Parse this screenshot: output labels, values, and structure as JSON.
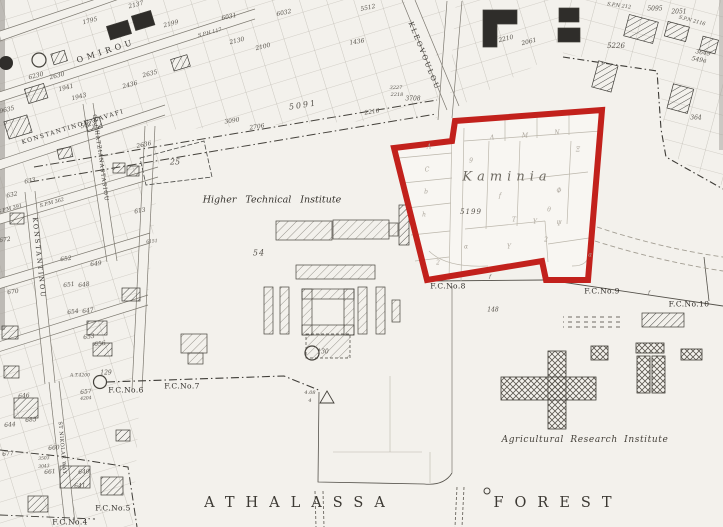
{
  "map": {
    "region_name": "Kaminia",
    "forest_word_left": "ATHALASSA",
    "forest_word_right": "FOREST",
    "institutes": {
      "higher_technical": "Higher Technical Institute",
      "agricultural": "Agricultural Research Institute"
    },
    "colors": {
      "boundary_red": "#c2211c",
      "paper": "#f3f1ec",
      "ink": "#3c3933"
    }
  },
  "fc_markers": [
    {
      "t": "F.C.No.4",
      "x": 70,
      "y": 522
    },
    {
      "t": "F.C.No.5",
      "x": 113,
      "y": 508
    },
    {
      "t": "F.C.No.6",
      "x": 126,
      "y": 390
    },
    {
      "t": "F.C.No.7",
      "x": 182,
      "y": 386
    },
    {
      "t": "F.C.No.8",
      "x": 448,
      "y": 286
    },
    {
      "t": "F.C.No.9",
      "x": 602,
      "y": 291
    },
    {
      "t": "F.C.No.10",
      "x": 689,
      "y": 304
    }
  ],
  "streets": [
    {
      "t": "OMIROU",
      "x": 106,
      "y": 51,
      "r": -18,
      "s": 8,
      "ls": 4
    },
    {
      "t": "KONSTANTINOU KAVAFI",
      "x": 73,
      "y": 127,
      "r": -17,
      "s": 6,
      "ls": 1.5
    },
    {
      "t": "G. CHATZIANASTASIOU",
      "x": 100,
      "y": 158,
      "r": 82,
      "s": 5.5,
      "ls": 1
    },
    {
      "t": "KONSTANTINOU",
      "x": 39,
      "y": 258,
      "r": 84,
      "s": 6.5,
      "ls": 2
    },
    {
      "t": "KLEOVOULOU",
      "x": 424,
      "y": 56,
      "r": 68,
      "s": 7,
      "ls": 2
    },
    {
      "t": "ST NIKOLAE WAY",
      "x": 62,
      "y": 448,
      "r": 85,
      "s": 5,
      "ls": 0.5
    }
  ],
  "plot_numbers": [
    {
      "t": "2137",
      "x": 136,
      "y": 5,
      "r": -15
    },
    {
      "t": "1795",
      "x": 90,
      "y": 21,
      "r": -15
    },
    {
      "t": "2199",
      "x": 171,
      "y": 24,
      "r": -15
    },
    {
      "t": "6031",
      "x": 229,
      "y": 17,
      "r": -12
    },
    {
      "t": "6032",
      "x": 284,
      "y": 13,
      "r": -12
    },
    {
      "t": "5512",
      "x": 368,
      "y": 8,
      "r": -12
    },
    {
      "t": "2130",
      "x": 237,
      "y": 41,
      "r": -14
    },
    {
      "t": "2100",
      "x": 263,
      "y": 47,
      "r": -14
    },
    {
      "t": "1436",
      "x": 357,
      "y": 42,
      "r": -10
    },
    {
      "t": "2210",
      "x": 506,
      "y": 39,
      "r": -14
    },
    {
      "t": "2061",
      "x": 529,
      "y": 42,
      "r": -14
    },
    {
      "t": "9635",
      "x": 7,
      "y": 110,
      "r": -14
    },
    {
      "t": "6230",
      "x": 36,
      "y": 76,
      "r": -15
    },
    {
      "t": "2630",
      "x": 57,
      "y": 76,
      "r": -15
    },
    {
      "t": "2635",
      "x": 150,
      "y": 74,
      "r": -15
    },
    {
      "t": "2436",
      "x": 130,
      "y": 85,
      "r": -15
    },
    {
      "t": "1941",
      "x": 66,
      "y": 88,
      "r": -15
    },
    {
      "t": "1943",
      "x": 79,
      "y": 97,
      "r": -15
    },
    {
      "t": "5023",
      "x": 88,
      "y": 125,
      "r": -15
    },
    {
      "t": "2636",
      "x": 144,
      "y": 145,
      "r": -12
    },
    {
      "t": "613",
      "x": 140,
      "y": 211,
      "r": -10
    },
    {
      "t": "S.P.M 362",
      "x": 52,
      "y": 203,
      "r": -15,
      "s": 5
    },
    {
      "t": "S.P.M 391",
      "x": 10,
      "y": 209,
      "r": -15,
      "s": 5
    },
    {
      "t": "S.P.H 117",
      "x": 210,
      "y": 33,
      "r": -15,
      "s": 5
    },
    {
      "t": "633",
      "x": 30,
      "y": 181,
      "r": -12
    },
    {
      "t": "632",
      "x": 12,
      "y": 195,
      "r": -12
    },
    {
      "t": "672",
      "x": 5,
      "y": 240,
      "r": -8
    },
    {
      "t": "652",
      "x": 66,
      "y": 259,
      "r": -8
    },
    {
      "t": "649",
      "x": 96,
      "y": 264,
      "r": -8
    },
    {
      "t": "651",
      "x": 69,
      "y": 285,
      "r": -8
    },
    {
      "t": "648",
      "x": 84,
      "y": 285,
      "r": -8
    },
    {
      "t": "670",
      "x": 13,
      "y": 292,
      "r": -8
    },
    {
      "t": "654",
      "x": 73,
      "y": 312,
      "r": -8
    },
    {
      "t": "647",
      "x": 88,
      "y": 311,
      "r": -8
    },
    {
      "t": "653",
      "x": 89,
      "y": 337,
      "r": -8
    },
    {
      "t": "656",
      "x": 100,
      "y": 344,
      "r": -8
    },
    {
      "t": "129",
      "x": 106,
      "y": 373,
      "r": 0
    },
    {
      "t": "A.T.4200",
      "x": 80,
      "y": 376,
      "r": 0,
      "s": 4.5
    },
    {
      "t": "646",
      "x": 24,
      "y": 396,
      "r": -5
    },
    {
      "t": "685",
      "x": 31,
      "y": 420,
      "r": -5
    },
    {
      "t": "644",
      "x": 10,
      "y": 425,
      "r": -5
    },
    {
      "t": "657",
      "x": 86,
      "y": 392,
      "r": -5
    },
    {
      "t": "4204",
      "x": 86,
      "y": 399,
      "r": -5,
      "s": 4.5
    },
    {
      "t": "660",
      "x": 54,
      "y": 448,
      "r": -5
    },
    {
      "t": "661",
      "x": 50,
      "y": 472,
      "r": -5
    },
    {
      "t": "3503",
      "x": 44,
      "y": 459,
      "r": -5,
      "s": 4.5
    },
    {
      "t": "3043",
      "x": 44,
      "y": 467,
      "r": -5,
      "s": 4.5
    },
    {
      "t": "640",
      "x": 84,
      "y": 472,
      "r": -5
    },
    {
      "t": "641",
      "x": 80,
      "y": 486,
      "r": -5
    },
    {
      "t": "677",
      "x": 8,
      "y": 454,
      "r": -5
    },
    {
      "t": "S.P.N 212",
      "x": 619,
      "y": 6,
      "r": 8,
      "s": 5
    },
    {
      "t": "5095",
      "x": 655,
      "y": 9,
      "r": 0
    },
    {
      "t": "2051",
      "x": 679,
      "y": 12,
      "r": 0
    },
    {
      "t": "S.P.N 2116",
      "x": 692,
      "y": 21,
      "r": 15,
      "s": 5
    },
    {
      "t": "5226",
      "x": 616,
      "y": 46,
      "r": 0,
      "s": 7
    },
    {
      "t": "3649",
      "x": 703,
      "y": 53,
      "r": 10
    },
    {
      "t": "549a",
      "x": 699,
      "y": 60,
      "r": 10
    },
    {
      "t": "364",
      "x": 696,
      "y": 118,
      "r": 0
    },
    {
      "t": "2216",
      "x": 372,
      "y": 112,
      "r": -9
    },
    {
      "t": "3708",
      "x": 413,
      "y": 99,
      "r": 0
    },
    {
      "t": "3227",
      "x": 396,
      "y": 88,
      "r": 0,
      "s": 5
    },
    {
      "t": "2218",
      "x": 397,
      "y": 95,
      "r": 0,
      "s": 5
    },
    {
      "t": "2706",
      "x": 257,
      "y": 127,
      "r": -9
    },
    {
      "t": "3090",
      "x": 232,
      "y": 121,
      "r": -9
    },
    {
      "t": "5091",
      "x": 303,
      "y": 105,
      "r": -9,
      "s": 8,
      "ls": 2
    },
    {
      "t": "25",
      "x": 175,
      "y": 162,
      "r": 0,
      "s": 8
    },
    {
      "t": "54",
      "x": 259,
      "y": 253,
      "r": 0,
      "s": 8,
      "ls": 1
    },
    {
      "t": "5199",
      "x": 471,
      "y": 212,
      "r": 0,
      "s": 7,
      "ls": 1
    },
    {
      "t": "130",
      "x": 323,
      "y": 352,
      "r": 0
    },
    {
      "t": "148",
      "x": 493,
      "y": 310,
      "r": 0
    },
    {
      "t": "6151",
      "x": 152,
      "y": 242,
      "r": -5,
      "s": 4.5
    },
    {
      "t": "f",
      "x": 490,
      "y": 277,
      "r": 0,
      "s": 5
    },
    {
      "t": "f",
      "x": 649,
      "y": 293,
      "r": 0,
      "s": 5
    },
    {
      "t": "4.08",
      "x": 310,
      "y": 393,
      "r": 0,
      "s": 5
    },
    {
      "t": "4",
      "x": 310,
      "y": 401,
      "r": 0,
      "s": 5
    }
  ],
  "parcel_letters": [
    {
      "t": "Λ",
      "x": 492,
      "y": 138
    },
    {
      "t": "M",
      "x": 525,
      "y": 136
    },
    {
      "t": "N",
      "x": 557,
      "y": 133
    },
    {
      "t": "9",
      "x": 471,
      "y": 161
    },
    {
      "t": "Ξ",
      "x": 578,
      "y": 150
    },
    {
      "t": "Φ",
      "x": 559,
      "y": 191
    },
    {
      "t": "f",
      "x": 500,
      "y": 196
    },
    {
      "t": "θ",
      "x": 549,
      "y": 210
    },
    {
      "t": "T",
      "x": 514,
      "y": 220
    },
    {
      "t": "Y",
      "x": 535,
      "y": 222
    },
    {
      "t": "Ψ",
      "x": 559,
      "y": 224
    },
    {
      "t": "Y",
      "x": 509,
      "y": 247
    },
    {
      "t": "2",
      "x": 546,
      "y": 240
    },
    {
      "t": "A",
      "x": 429,
      "y": 147
    },
    {
      "t": "C",
      "x": 427,
      "y": 170
    },
    {
      "t": "b",
      "x": 426,
      "y": 192
    },
    {
      "t": "h",
      "x": 424,
      "y": 215
    },
    {
      "t": "2",
      "x": 438,
      "y": 263
    },
    {
      "t": "a",
      "x": 590,
      "y": 255
    },
    {
      "t": "α",
      "x": 466,
      "y": 247
    }
  ]
}
